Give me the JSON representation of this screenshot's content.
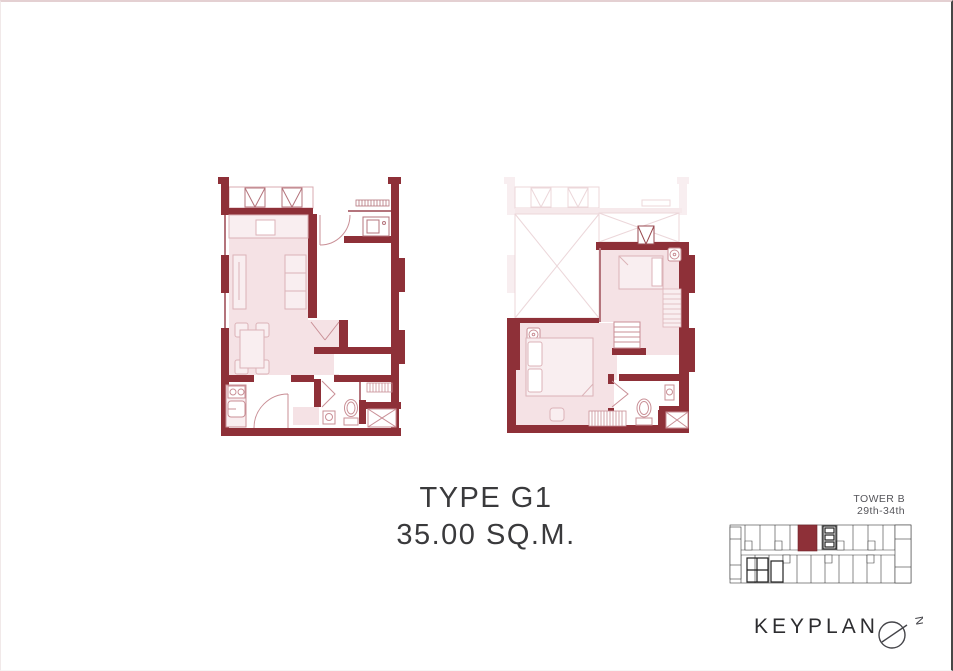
{
  "title": {
    "type_label": "TYPE G1",
    "area_label": "35.00 SQ.M."
  },
  "keyplan": {
    "tower_label": "TOWER B",
    "floors_label": "29th-34th",
    "caption": "KEYPLAN",
    "north_label": "N"
  },
  "colors": {
    "wall": "#8e3038",
    "room_fill": "#f5e2e5",
    "furniture_fill": "#f9eef0",
    "furniture_stroke": "#c98f96",
    "thin_wall": "#b4747c",
    "ghost_stroke": "#ecd7da",
    "ghost_fill": "#f8eef0",
    "title_text": "#3a3a3c",
    "keyplan_text": "#55555a",
    "keyplan_line": "#3a3a3a",
    "highlight_unit": "#8e3038"
  },
  "icons": {
    "ac_unit": "square-with-v-diagonals",
    "shaft": "box-with-x",
    "north_compass": "circle-with-needle"
  }
}
